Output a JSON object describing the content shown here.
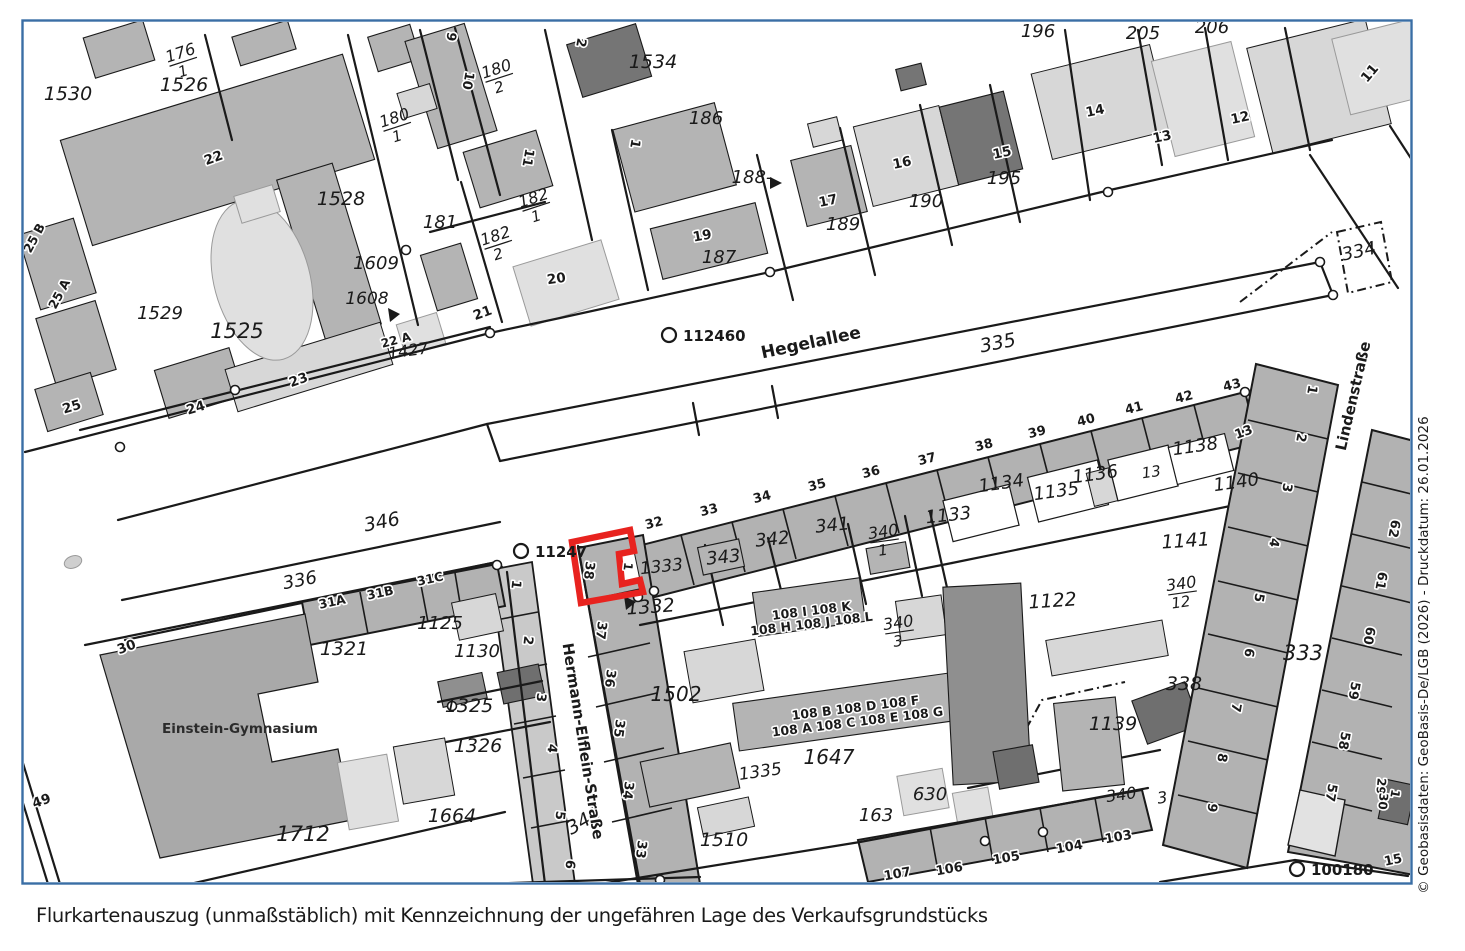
{
  "caption": "Flurkartenauszug (unmaßstäblich) mit Kennzeichnung der ungefähren Lage des Verkaufsgrundstücks",
  "credit": "© Geobasisdaten: GeoBasis-De/LGB (2026) - Druckdatum: 26.01.2026",
  "colors": {
    "highlight": "#e8231f",
    "frame": "#3a6ea5",
    "credit_text": "#8195a6",
    "caption_text": "#3b3b3b"
  },
  "highlight": {
    "meaning": "ungefähre Lage des Verkaufsgrundstücks",
    "path": "M572,542 L630,530 L634,551 L619,554 L622,584 L640,580 L643,592 L581,603 Z"
  },
  "markers": [
    {
      "label": "112460",
      "x": 669,
      "y": 335
    },
    {
      "label": "11247",
      "x": 521,
      "y": 551
    },
    {
      "label": "100180",
      "x": 1297,
      "y": 869
    }
  ],
  "streets": [
    {
      "t": "Hegelallee",
      "x": 812,
      "y": 348,
      "r": -12,
      "fs": 17
    },
    {
      "t": "Hermann-Elflein-Straße",
      "x": 578,
      "y": 742,
      "r": 81,
      "fs": 15
    },
    {
      "t": "Lindenstraße",
      "x": 1358,
      "y": 397,
      "r": -77,
      "fs": 15
    }
  ],
  "poi": [
    {
      "t": "Einstein-Gymnasium",
      "x": 240,
      "y": 733,
      "r": 0,
      "fs": 13.5
    }
  ],
  "fractions": [
    {
      "num": "176",
      "den": "1",
      "x": 182,
      "y": 58,
      "r": -18
    },
    {
      "num": "180",
      "den": "2",
      "x": 498,
      "y": 74,
      "r": -18
    },
    {
      "num": "180",
      "den": "1",
      "x": 396,
      "y": 123,
      "r": -18
    },
    {
      "num": "182",
      "den": "1",
      "x": 535,
      "y": 203,
      "r": -18
    },
    {
      "num": "182",
      "den": "2",
      "x": 497,
      "y": 241,
      "r": -18
    },
    {
      "num": "340",
      "den": "1",
      "x": 884,
      "y": 537,
      "r": -8
    },
    {
      "num": "340",
      "den": "3",
      "x": 899,
      "y": 628,
      "r": -8
    },
    {
      "num": "340",
      "den": "12",
      "x": 1182,
      "y": 589,
      "r": -8
    }
  ],
  "parcel_labels": [
    {
      "t": "1530",
      "x": 68,
      "y": 100,
      "r": 0,
      "fs": 19
    },
    {
      "t": "1526",
      "x": 184,
      "y": 91,
      "r": 0,
      "fs": 19
    },
    {
      "t": "1528",
      "x": 341,
      "y": 205,
      "r": 0,
      "fs": 19
    },
    {
      "t": "1529",
      "x": 160,
      "y": 319,
      "r": 0,
      "fs": 18
    },
    {
      "t": "1525",
      "x": 237,
      "y": 338,
      "r": 0,
      "fs": 21
    },
    {
      "t": "181",
      "x": 440,
      "y": 228,
      "r": 0,
      "fs": 18
    },
    {
      "t": "1609",
      "x": 376,
      "y": 269,
      "r": 0,
      "fs": 18
    },
    {
      "t": "1608",
      "x": 367,
      "y": 304,
      "r": 0,
      "fs": 17
    },
    {
      "t": "1427",
      "x": 409,
      "y": 356,
      "r": -8,
      "fs": 16
    },
    {
      "t": "1534",
      "x": 653,
      "y": 68,
      "r": 0,
      "fs": 19
    },
    {
      "t": "186",
      "x": 706,
      "y": 124,
      "r": 0,
      "fs": 18
    },
    {
      "t": "187",
      "x": 719,
      "y": 263,
      "r": 0,
      "fs": 18
    },
    {
      "t": "188-",
      "x": 752,
      "y": 183,
      "r": 0,
      "fs": 18
    },
    {
      "t": "189",
      "x": 843,
      "y": 230,
      "r": 0,
      "fs": 18
    },
    {
      "t": "190",
      "x": 926,
      "y": 207,
      "r": 0,
      "fs": 18
    },
    {
      "t": "195",
      "x": 1004,
      "y": 184,
      "r": 0,
      "fs": 18
    },
    {
      "t": "196",
      "x": 1038,
      "y": 37,
      "r": 0,
      "fs": 18
    },
    {
      "t": "205",
      "x": 1143,
      "y": 39,
      "r": 0,
      "fs": 18
    },
    {
      "t": "206",
      "x": 1212,
      "y": 33,
      "r": 0,
      "fs": 18
    },
    {
      "t": "334",
      "x": 1360,
      "y": 257,
      "r": -12,
      "fs": 18
    },
    {
      "t": "335",
      "x": 999,
      "y": 349,
      "r": -11,
      "fs": 19
    },
    {
      "t": "346",
      "x": 383,
      "y": 528,
      "r": -11,
      "fs": 19
    },
    {
      "t": "336",
      "x": 301,
      "y": 586,
      "r": -11,
      "fs": 18
    },
    {
      "t": "345",
      "x": 587,
      "y": 826,
      "r": -30,
      "fs": 19
    },
    {
      "t": "341",
      "x": 833,
      "y": 531,
      "r": -6,
      "fs": 18
    },
    {
      "t": "342",
      "x": 773,
      "y": 545,
      "r": -6,
      "fs": 18
    },
    {
      "t": "343",
      "x": 724,
      "y": 563,
      "r": -6,
      "fs": 18
    },
    {
      "t": "1333",
      "x": 662,
      "y": 572,
      "r": -6,
      "fs": 17
    },
    {
      "t": "1332",
      "x": 651,
      "y": 613,
      "r": -4,
      "fs": 19
    },
    {
      "t": "1133",
      "x": 949,
      "y": 521,
      "r": -6,
      "fs": 18
    },
    {
      "t": "1134",
      "x": 1002,
      "y": 489,
      "r": -8,
      "fs": 18
    },
    {
      "t": "1135",
      "x": 1057,
      "y": 497,
      "r": -8,
      "fs": 18
    },
    {
      "t": "1136",
      "x": 1096,
      "y": 480,
      "r": -8,
      "fs": 18
    },
    {
      "t": "13",
      "x": 1152,
      "y": 477,
      "r": -8,
      "fs": 15
    },
    {
      "t": "1138",
      "x": 1196,
      "y": 452,
      "r": -8,
      "fs": 18
    },
    {
      "t": "1140",
      "x": 1237,
      "y": 488,
      "r": -8,
      "fs": 18
    },
    {
      "t": "1141",
      "x": 1186,
      "y": 547,
      "r": -4,
      "fs": 19
    },
    {
      "t": "1122",
      "x": 1053,
      "y": 607,
      "r": -4,
      "fs": 19
    },
    {
      "t": "338",
      "x": 1184,
      "y": 690,
      "r": 0,
      "fs": 19
    },
    {
      "t": "1139",
      "x": 1113,
      "y": 730,
      "r": 0,
      "fs": 19
    },
    {
      "t": "333",
      "x": 1303,
      "y": 660,
      "r": 0,
      "fs": 21
    },
    {
      "t": "1125",
      "x": 440,
      "y": 629,
      "r": 0,
      "fs": 18
    },
    {
      "t": "1130",
      "x": 477,
      "y": 657,
      "r": 0,
      "fs": 18
    },
    {
      "t": "1321",
      "x": 344,
      "y": 655,
      "r": 0,
      "fs": 19
    },
    {
      "t": "1325",
      "x": 469,
      "y": 712,
      "r": 0,
      "fs": 19
    },
    {
      "t": "1326",
      "x": 478,
      "y": 752,
      "r": 0,
      "fs": 19
    },
    {
      "t": "1664",
      "x": 452,
      "y": 822,
      "r": 0,
      "fs": 19
    },
    {
      "t": "1712",
      "x": 303,
      "y": 841,
      "r": 0,
      "fs": 21
    },
    {
      "t": "1502",
      "x": 676,
      "y": 701,
      "r": 0,
      "fs": 20
    },
    {
      "t": "1510",
      "x": 724,
      "y": 846,
      "r": 0,
      "fs": 19
    },
    {
      "t": "1335",
      "x": 761,
      "y": 777,
      "r": -8,
      "fs": 17
    },
    {
      "t": "1647",
      "x": 829,
      "y": 764,
      "r": 0,
      "fs": 20
    },
    {
      "t": "630",
      "x": 930,
      "y": 800,
      "r": 0,
      "fs": 18
    },
    {
      "t": "163",
      "x": 876,
      "y": 821,
      "r": 0,
      "fs": 18
    },
    {
      "t": "340",
      "x": 1122,
      "y": 800,
      "r": -8,
      "fs": 16
    },
    {
      "t": "3",
      "x": 1163,
      "y": 803,
      "r": -8,
      "fs": 16
    }
  ],
  "house_numbers": [
    {
      "t": "22",
      "x": 215,
      "y": 162,
      "r": -20
    },
    {
      "t": "23",
      "x": 300,
      "y": 384,
      "r": -20
    },
    {
      "t": "24",
      "x": 197,
      "y": 412,
      "r": -17
    },
    {
      "t": "25",
      "x": 73,
      "y": 411,
      "r": -17
    },
    {
      "t": "25 B",
      "x": 38,
      "y": 240,
      "r": -62,
      "fs": 12.5
    },
    {
      "t": "25 A",
      "x": 63,
      "y": 296,
      "r": -62,
      "fs": 12.5
    },
    {
      "t": "21",
      "x": 484,
      "y": 317,
      "r": -20
    },
    {
      "t": "20",
      "x": 557,
      "y": 283,
      "r": -8
    },
    {
      "t": "19",
      "x": 703,
      "y": 240,
      "r": -10
    },
    {
      "t": "22 A",
      "x": 397,
      "y": 344,
      "r": -15,
      "fs": 12
    },
    {
      "t": "17",
      "x": 829,
      "y": 205,
      "r": -12
    },
    {
      "t": "16",
      "x": 903,
      "y": 167,
      "r": -12
    },
    {
      "t": "15",
      "x": 1003,
      "y": 157,
      "r": -12
    },
    {
      "t": "14",
      "x": 1096,
      "y": 115,
      "r": -12
    },
    {
      "t": "13",
      "x": 1163,
      "y": 141,
      "r": -12
    },
    {
      "t": "12",
      "x": 1241,
      "y": 122,
      "r": -12
    },
    {
      "t": "11",
      "x": 1373,
      "y": 76,
      "r": -50
    },
    {
      "t": "9",
      "x": 447,
      "y": 36,
      "r": 100,
      "fs": 13
    },
    {
      "t": "10",
      "x": 464,
      "y": 80,
      "r": 100,
      "fs": 13
    },
    {
      "t": "2",
      "x": 577,
      "y": 42,
      "r": 100,
      "fs": 13
    },
    {
      "t": "11",
      "x": 524,
      "y": 157,
      "r": 100,
      "fs": 13
    },
    {
      "t": "1",
      "x": 631,
      "y": 143,
      "r": 100,
      "fs": 13
    },
    {
      "t": "30",
      "x": 128,
      "y": 651,
      "r": -20
    },
    {
      "t": "49",
      "x": 43,
      "y": 805,
      "r": -20
    },
    {
      "t": "31A",
      "x": 333,
      "y": 606,
      "r": -12,
      "fs": 12.5
    },
    {
      "t": "31B",
      "x": 381,
      "y": 597,
      "r": -12,
      "fs": 12.5
    },
    {
      "t": "31C",
      "x": 431,
      "y": 583,
      "r": -12,
      "fs": 12.5
    },
    {
      "t": "32",
      "x": 655,
      "y": 527,
      "r": -14,
      "fs": 13
    },
    {
      "t": "33",
      "x": 710,
      "y": 514,
      "r": -14,
      "fs": 13
    },
    {
      "t": "34",
      "x": 763,
      "y": 501,
      "r": -14,
      "fs": 13
    },
    {
      "t": "35",
      "x": 818,
      "y": 489,
      "r": -14,
      "fs": 13
    },
    {
      "t": "36",
      "x": 872,
      "y": 476,
      "r": -14,
      "fs": 13
    },
    {
      "t": "37",
      "x": 928,
      "y": 463,
      "r": -14,
      "fs": 13
    },
    {
      "t": "38",
      "x": 985,
      "y": 449,
      "r": -14,
      "fs": 13
    },
    {
      "t": "39",
      "x": 1038,
      "y": 436,
      "r": -14,
      "fs": 13
    },
    {
      "t": "40",
      "x": 1087,
      "y": 424,
      "r": -14,
      "fs": 13
    },
    {
      "t": "41",
      "x": 1135,
      "y": 412,
      "r": -14,
      "fs": 13
    },
    {
      "t": "42",
      "x": 1185,
      "y": 401,
      "r": -14,
      "fs": 13
    },
    {
      "t": "43",
      "x": 1233,
      "y": 389,
      "r": -14,
      "fs": 13
    },
    {
      "t": "1",
      "x": 512,
      "y": 584,
      "r": 97,
      "fs": 13
    },
    {
      "t": "2",
      "x": 524,
      "y": 640,
      "r": 97,
      "fs": 13
    },
    {
      "t": "3",
      "x": 537,
      "y": 697,
      "r": 97,
      "fs": 13
    },
    {
      "t": "4",
      "x": 548,
      "y": 748,
      "r": 97,
      "fs": 13
    },
    {
      "t": "5",
      "x": 556,
      "y": 815,
      "r": 97,
      "fs": 13
    },
    {
      "t": "6",
      "x": 566,
      "y": 864,
      "r": 97,
      "fs": 13
    },
    {
      "t": "38",
      "x": 585,
      "y": 570,
      "r": 97,
      "fs": 13
    },
    {
      "t": "37",
      "x": 597,
      "y": 630,
      "r": 97,
      "fs": 13
    },
    {
      "t": "36",
      "x": 606,
      "y": 678,
      "r": 97,
      "fs": 13
    },
    {
      "t": "35",
      "x": 615,
      "y": 728,
      "r": 97,
      "fs": 13
    },
    {
      "t": "34",
      "x": 624,
      "y": 790,
      "r": 97,
      "fs": 13
    },
    {
      "t": "33",
      "x": 637,
      "y": 849,
      "r": 97,
      "fs": 13
    },
    {
      "t": "1",
      "x": 624,
      "y": 566,
      "r": 97,
      "fs": 12
    },
    {
      "t": "107",
      "x": 898,
      "y": 878,
      "r": -10,
      "fs": 13
    },
    {
      "t": "106",
      "x": 950,
      "y": 873,
      "r": -10,
      "fs": 13
    },
    {
      "t": "105",
      "x": 1007,
      "y": 862,
      "r": -10,
      "fs": 13
    },
    {
      "t": "104",
      "x": 1070,
      "y": 851,
      "r": -10,
      "fs": 13
    },
    {
      "t": "103",
      "x": 1119,
      "y": 841,
      "r": -10,
      "fs": 13
    },
    {
      "t": "1",
      "x": 1308,
      "y": 389,
      "r": 100,
      "fs": 13
    },
    {
      "t": "2",
      "x": 1297,
      "y": 437,
      "r": 100,
      "fs": 13
    },
    {
      "t": "3",
      "x": 1283,
      "y": 487,
      "r": 100,
      "fs": 13
    },
    {
      "t": "4",
      "x": 1270,
      "y": 542,
      "r": 100,
      "fs": 13
    },
    {
      "t": "5",
      "x": 1255,
      "y": 597,
      "r": 100,
      "fs": 13
    },
    {
      "t": "6",
      "x": 1245,
      "y": 652,
      "r": 100,
      "fs": 13
    },
    {
      "t": "7",
      "x": 1232,
      "y": 707,
      "r": 100,
      "fs": 13
    },
    {
      "t": "8",
      "x": 1218,
      "y": 757,
      "r": 100,
      "fs": 13
    },
    {
      "t": "9",
      "x": 1208,
      "y": 807,
      "r": 100,
      "fs": 13
    },
    {
      "t": "62",
      "x": 1390,
      "y": 528,
      "r": 100,
      "fs": 13
    },
    {
      "t": "61",
      "x": 1377,
      "y": 580,
      "r": 100,
      "fs": 13
    },
    {
      "t": "60",
      "x": 1365,
      "y": 635,
      "r": 100,
      "fs": 13
    },
    {
      "t": "59",
      "x": 1350,
      "y": 690,
      "r": 100,
      "fs": 13
    },
    {
      "t": "58",
      "x": 1340,
      "y": 740,
      "r": 100,
      "fs": 13
    },
    {
      "t": "57",
      "x": 1327,
      "y": 792,
      "r": 100,
      "fs": 13
    },
    {
      "t": "29",
      "x": 1377,
      "y": 786,
      "r": 95,
      "fs": 12
    },
    {
      "t": "30",
      "x": 1379,
      "y": 801,
      "r": 95,
      "fs": 12
    },
    {
      "t": "1",
      "x": 1391,
      "y": 793,
      "r": 100,
      "fs": 12
    },
    {
      "t": "13",
      "x": 1245,
      "y": 436,
      "r": -20,
      "fs": 13
    },
    {
      "t": "15",
      "x": 1394,
      "y": 864,
      "r": -12,
      "fs": 13
    }
  ],
  "building_labels": [
    {
      "t": "108 I 108 K",
      "x": 812,
      "y": 615,
      "r": -7,
      "fs": 12.5
    },
    {
      "t": "108 H 108 J 108 L",
      "x": 812,
      "y": 628,
      "r": -7,
      "fs": 12.5
    },
    {
      "t": "108 B 108 D 108 F",
      "x": 856,
      "y": 712,
      "r": -7,
      "fs": 12.5
    },
    {
      "t": "108 A 108 C 108 E 108 G",
      "x": 858,
      "y": 726,
      "r": -7,
      "fs": 12.5
    }
  ]
}
